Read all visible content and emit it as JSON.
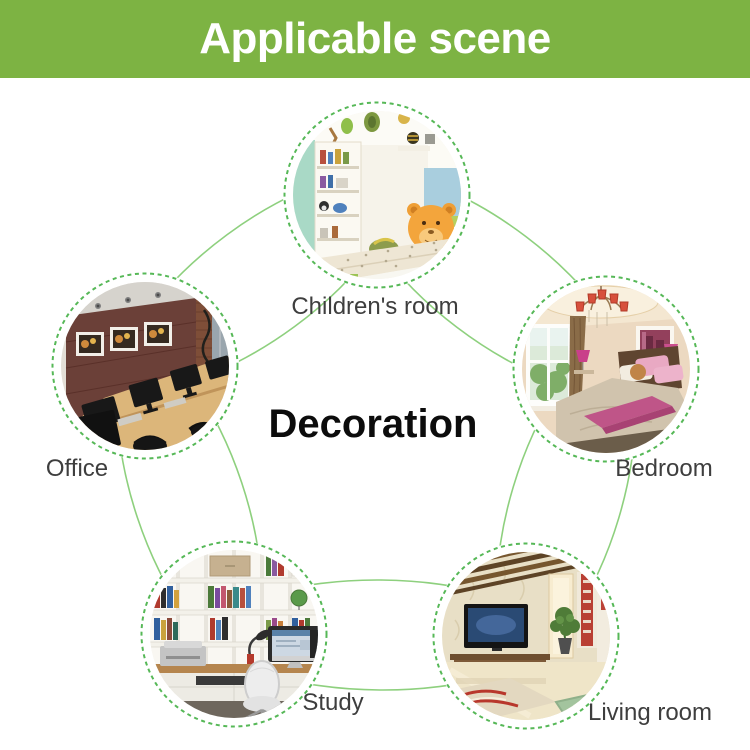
{
  "banner": {
    "title": "Applicable scene",
    "bg_color": "#7db343",
    "text_color": "#ffffff"
  },
  "center_label": "Decoration",
  "nodes": [
    {
      "id": "children-room",
      "label": "Children's room"
    },
    {
      "id": "bedroom",
      "label": "Bedroom"
    },
    {
      "id": "living-room",
      "label": "Living room"
    },
    {
      "id": "study",
      "label": "Study"
    },
    {
      "id": "office",
      "label": "Office"
    }
  ],
  "style": {
    "connector_color": "#8ed07e",
    "ring_dash_color": "#56b857",
    "label_color": "#3e3e3e",
    "center_label_color": "#0c0c0c"
  }
}
